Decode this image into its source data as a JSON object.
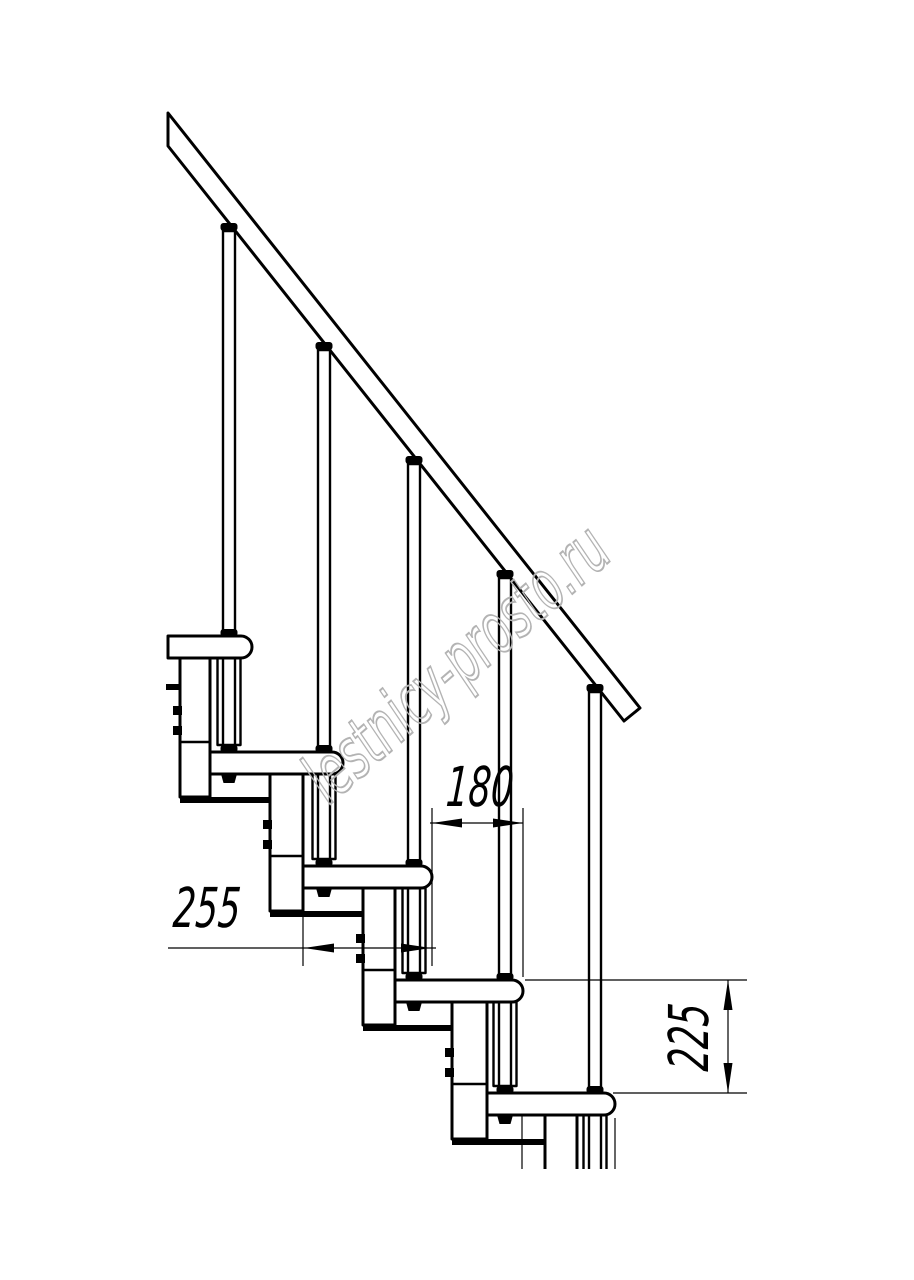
{
  "canvas": {
    "width": 914,
    "height": 1280,
    "background": "#ffffff"
  },
  "watermark": {
    "text": "lestnicy-prosto.ru",
    "x": 456,
    "y": 663,
    "rotate": -41,
    "font_size": 70,
    "scale_x": 0.62,
    "color": "#b3b3b3",
    "stroke_width": 2
  },
  "dim_text": {
    "font_size": 55,
    "scale_x": 0.64,
    "skew_x": -4,
    "color": "#000000"
  },
  "drawing": {
    "stroke_color": "#000000",
    "cut_y": 1169,
    "plate_h": 6,
    "tread_h": 22,
    "tread_r": 11,
    "handrail": {
      "outline": [
        [
          168,
          113
        ],
        [
          640,
          708
        ],
        [
          624,
          721
        ],
        [
          168,
          146
        ]
      ]
    },
    "treads": [
      {
        "left": 168,
        "right": 252,
        "top": 636
      },
      {
        "left": 210,
        "right": 343,
        "top": 752
      },
      {
        "left": 303,
        "right": 432,
        "top": 866
      },
      {
        "left": 395,
        "right": 523,
        "top": 980
      },
      {
        "left": 487,
        "right": 615,
        "top": 1093
      }
    ],
    "modules": [
      {
        "left": 180,
        "right": 210,
        "top": 658,
        "bottom": 797,
        "innerY": 742,
        "plateTo": 270,
        "screwYs": [
          706,
          726
        ]
      },
      {
        "left": 270,
        "right": 303,
        "top": 774,
        "bottom": 911,
        "innerY": 856,
        "plateTo": 363,
        "screwYs": [
          820,
          840
        ]
      },
      {
        "left": 363,
        "right": 395,
        "top": 888,
        "bottom": 1025,
        "innerY": 970,
        "plateTo": 452,
        "screwYs": [
          934,
          954
        ]
      },
      {
        "left": 452,
        "right": 487,
        "top": 1002,
        "bottom": 1139,
        "innerY": 1084,
        "plateTo": 545,
        "screwYs": [
          1048,
          1068
        ]
      },
      {
        "left": 545,
        "right": 577,
        "top": 1115,
        "bottom": 1172,
        "innerY": null,
        "plateTo": null,
        "screwYs": []
      }
    ],
    "stub_plate": {
      "x": 166,
      "y": 684,
      "w": 15,
      "h": 6
    },
    "balusters": [
      {
        "cx": 229,
        "capY": 223,
        "rodTop": 231,
        "rodBottom": 745,
        "sleeve": [
          658,
          745
        ],
        "passTread": 0,
        "anchorTread": 1
      },
      {
        "cx": 324,
        "capY": 342,
        "rodTop": 350,
        "rodBottom": 859,
        "sleeve": [
          774,
          859
        ],
        "passTread": 1,
        "anchorTread": 2
      },
      {
        "cx": 414,
        "capY": 456,
        "rodTop": 464,
        "rodBottom": 973,
        "sleeve": [
          888,
          973
        ],
        "passTread": 2,
        "anchorTread": 3
      },
      {
        "cx": 505,
        "capY": 570,
        "rodTop": 578,
        "rodBottom": 1086,
        "sleeve": [
          1002,
          1086
        ],
        "passTread": 3,
        "anchorTread": 4
      },
      {
        "cx": 595,
        "capY": 684,
        "rodTop": 692,
        "rodBottom": 1172,
        "sleeve": [
          1115,
          1172
        ],
        "passTread": 4,
        "anchorTread": null
      }
    ],
    "rod_w": 12,
    "sleeve_w": 23,
    "cap_w": 17,
    "cap_h": 8,
    "cut_ext_lines": [
      [
        522,
        1114,
        522,
        1172
      ],
      [
        615,
        1118,
        615,
        1172
      ]
    ]
  },
  "dimensions": [
    {
      "id": "dim-180",
      "label": "180",
      "line": [
        430,
        823,
        523,
        823
      ],
      "arrows": [
        [
          432,
          823,
          180
        ],
        [
          523,
          823,
          0
        ]
      ],
      "ext": [
        [
          432,
          808,
          432,
          966
        ],
        [
          523,
          808,
          523,
          977
        ]
      ],
      "label_pos": [
        480,
        787
      ],
      "label_rotate": 0
    },
    {
      "id": "dim-255",
      "label": "255",
      "line": [
        168,
        948,
        436,
        948
      ],
      "arrows": [
        [
          304,
          948,
          180
        ],
        [
          431,
          948,
          0
        ]
      ],
      "ext": [
        [
          303,
          917,
          303,
          966
        ]
      ],
      "label_pos": [
        207,
        908
      ],
      "label_rotate": 0
    },
    {
      "id": "dim-225",
      "label": "225",
      "line": [
        728,
        980,
        728,
        1093
      ],
      "arrows": [
        [
          728,
          980,
          270
        ],
        [
          728,
          1093,
          90
        ]
      ],
      "ext": [
        [
          525,
          980,
          747,
          980
        ],
        [
          613,
          1093,
          747,
          1093
        ]
      ],
      "label_pos": [
        689,
        1037
      ],
      "label_rotate": -90
    }
  ]
}
